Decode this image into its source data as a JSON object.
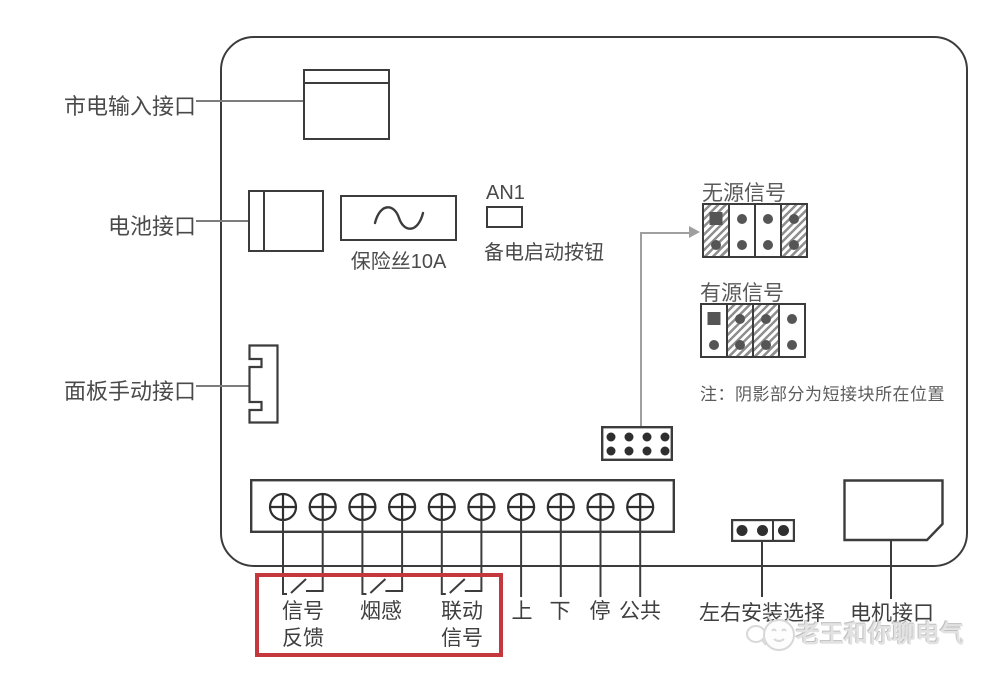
{
  "labels": {
    "mains_input": "市电输入接口",
    "battery": "电池接口",
    "fuse": "保险丝10A",
    "an1": "AN1",
    "backup_button": "备电启动按钮",
    "jumper_note": "注：阴影部分为短接块所在位置",
    "panel_manual": "面板手动接口",
    "lr_install_select": "左右安装选择",
    "motor_port": "电机接口"
  },
  "jumpers": {
    "passive": {
      "label": "无源信号",
      "columns": 4,
      "rows": 2,
      "hatched_columns": [
        1,
        4
      ]
    },
    "active": {
      "label": "有源信号",
      "columns": 4,
      "rows": 2,
      "hatched_columns": [
        2,
        3
      ]
    }
  },
  "terminal_block": {
    "terminal_count": 10,
    "groups": [
      {
        "l1": "信号",
        "l2": "反馈"
      },
      {
        "l1": "烟感",
        "l2": ""
      },
      {
        "l1": "联动",
        "l2": "信号"
      },
      {
        "l1": "上",
        "l2": ""
      },
      {
        "l1": "下",
        "l2": ""
      },
      {
        "l1": "停",
        "l2": ""
      },
      {
        "l1": "公共",
        "l2": ""
      }
    ]
  },
  "watermark": {
    "text": "老王和你聊电气"
  },
  "colors": {
    "line": "#3c3c3c",
    "leader": "#7d7d7d",
    "arrow": "#9f9f9f",
    "accent_red": "#c4373d",
    "hatch": "#8f8f8f",
    "marker": "#555555",
    "watermark": "#e2e2e2"
  }
}
